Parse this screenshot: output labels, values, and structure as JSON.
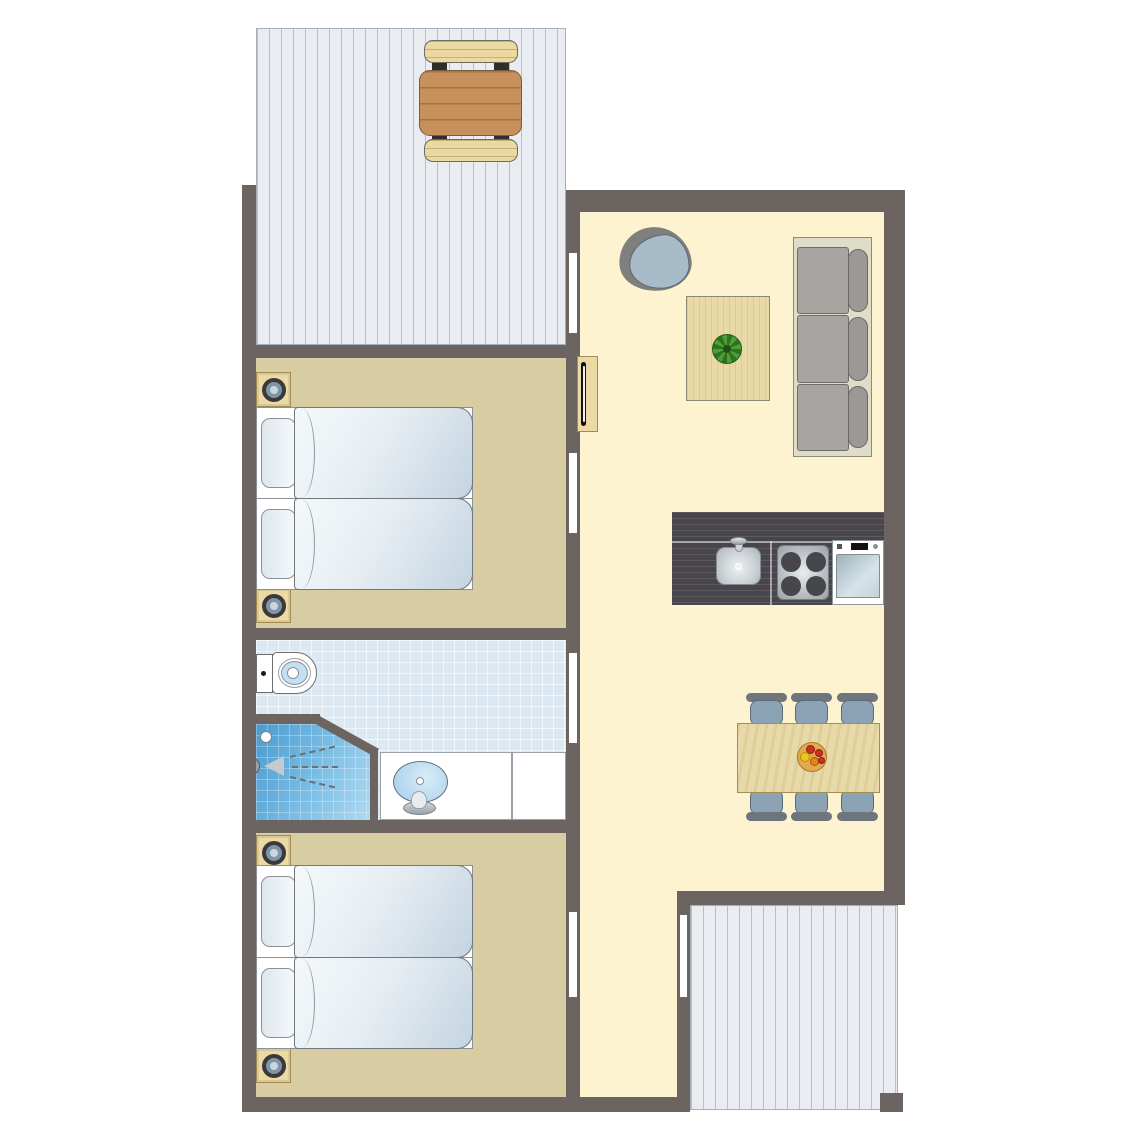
{
  "document": {
    "type": "floor-plan",
    "description": "Top-down floor plan of a two-bedroom holiday cottage with living room, open kitchen, bathroom and two terraces"
  },
  "palette": {
    "wall": "#6b6460",
    "living_floor": "#fdf3d1",
    "bedroom_floor": "#d8cda2",
    "bathroom_tile": "#dce8f2",
    "terrace_deck": "#e9edf2",
    "terrace_stripe": "#b6c0c9",
    "wood_light": "#ecd9a4",
    "wood_brown": "#c8905c",
    "kitchen_counter": "#48464b",
    "sofa_gray": "#a7a4a2",
    "chair_blue": "#8ca3b6",
    "shower_blue": "#4f9fd2",
    "basin_blue": "#badbf2",
    "plant_green": "#3a8a2d",
    "lamp_ring": "#7e96a8",
    "fruit_red": "#cc3026",
    "fruit_orange": "#e8821c",
    "fruit_yellow": "#ecc51c"
  },
  "rooms": [
    {
      "name": "terrace-top",
      "furniture": [
        "picnic-table",
        "bench",
        "bench"
      ]
    },
    {
      "name": "living-room",
      "furniture": [
        "egg-chair",
        "coffee-table",
        "potted-plant",
        "three-seat-sofa",
        "tv-cabinet"
      ]
    },
    {
      "name": "kitchen",
      "furniture": [
        "counter",
        "sink",
        "faucet",
        "cooktop-4-burners",
        "dishwasher"
      ]
    },
    {
      "name": "dining-area",
      "furniture": [
        "dining-table",
        "chair",
        "chair",
        "chair",
        "chair",
        "chair",
        "chair",
        "fruit-bowl"
      ]
    },
    {
      "name": "bedroom-1",
      "furniture": [
        "single-bed",
        "single-bed",
        "nightstand",
        "nightstand",
        "lamp",
        "lamp"
      ]
    },
    {
      "name": "bathroom",
      "furniture": [
        "toilet",
        "shower",
        "washbasin",
        "vanity-counter"
      ]
    },
    {
      "name": "bedroom-2",
      "furniture": [
        "single-bed",
        "single-bed",
        "nightstand",
        "nightstand",
        "lamp",
        "lamp"
      ]
    },
    {
      "name": "terrace-bottom",
      "furniture": [
        "corner-post"
      ]
    }
  ],
  "doors": [
    "terrace-door-living",
    "bedroom-1-door",
    "bathroom-door",
    "bedroom-2-door",
    "terrace-door-hall"
  ]
}
